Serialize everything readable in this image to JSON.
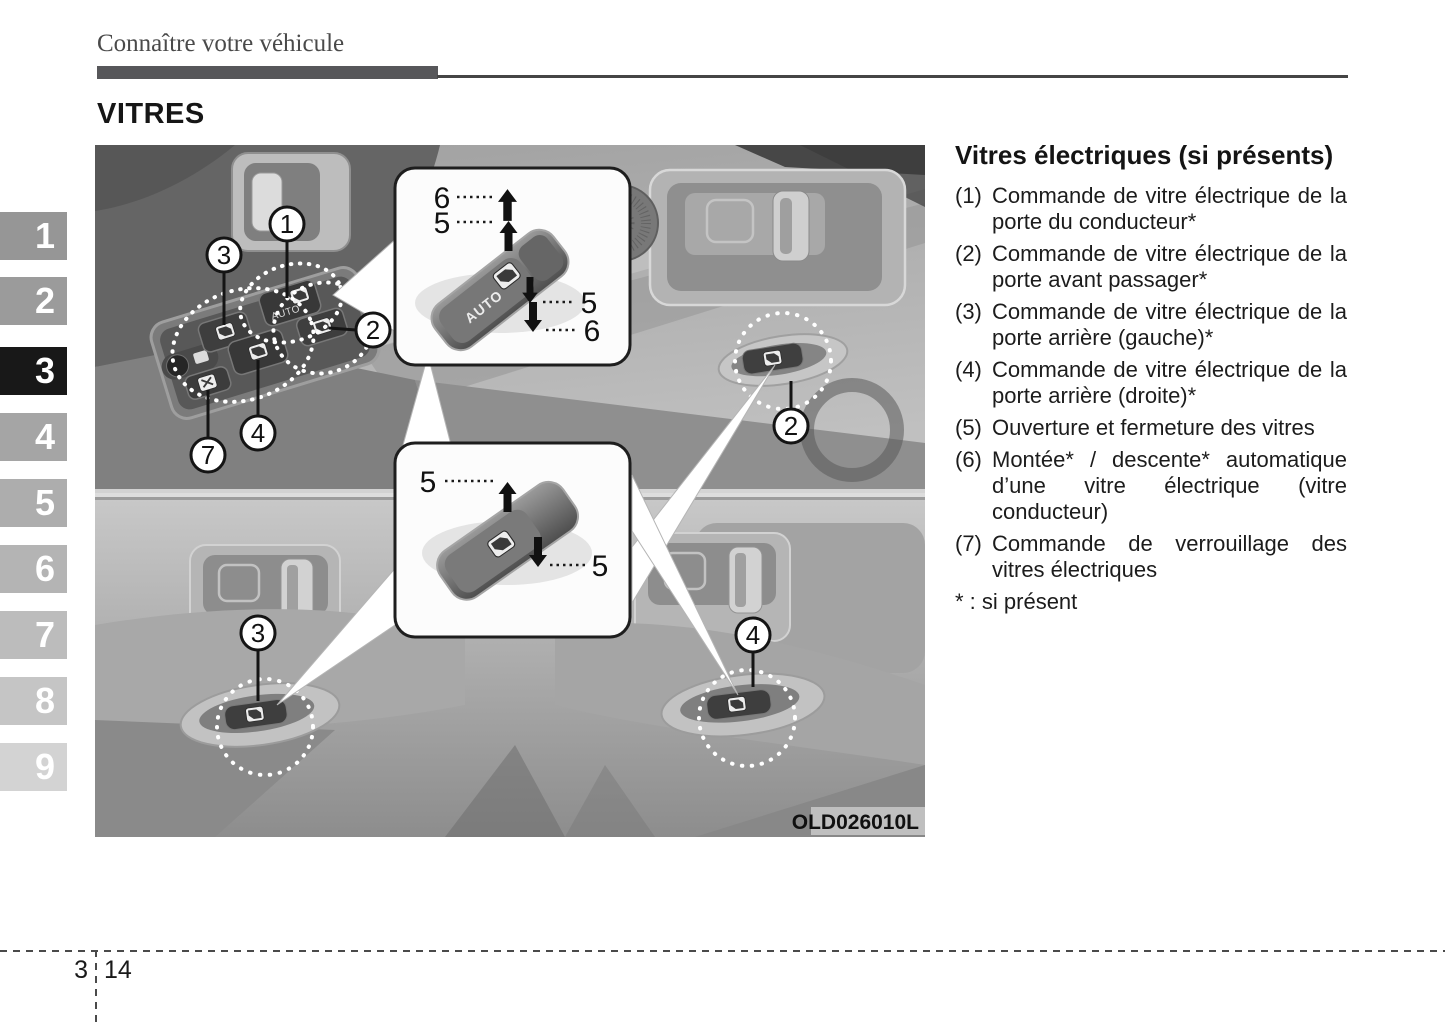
{
  "page": {
    "breadcrumb": "Connaître votre véhicule",
    "title": "VITRES",
    "footer": {
      "chapter": "3",
      "page": "14"
    }
  },
  "sidebar": {
    "tabs": [
      {
        "label": "1",
        "active": false
      },
      {
        "label": "2",
        "active": false
      },
      {
        "label": "3",
        "active": true
      },
      {
        "label": "4",
        "active": false
      },
      {
        "label": "5",
        "active": false
      },
      {
        "label": "6",
        "active": false
      },
      {
        "label": "7",
        "active": false
      },
      {
        "label": "8",
        "active": false
      },
      {
        "label": "9",
        "active": false
      }
    ]
  },
  "figure": {
    "code": "OLD026010L",
    "switch_auto_text": "AUTO",
    "callouts": {
      "driver_auto": "1",
      "cluster_front_passenger": "2",
      "cluster_rear_left": "3",
      "cluster_rear_right": "4",
      "window_lock": "7",
      "front_passenger_door": "2",
      "rear_left_door": "3",
      "rear_right_door": "4"
    },
    "inset_auto": {
      "up_auto": "6",
      "up_manual": "5",
      "down_manual": "5",
      "down_auto": "6"
    },
    "inset_manual": {
      "up": "5",
      "down": "5"
    }
  },
  "content": {
    "heading": "Vitres électriques (si présents)",
    "items": [
      {
        "num": "(1)",
        "text": "Commande de vitre électrique de la porte du conducteur*"
      },
      {
        "num": "(2)",
        "text": "Commande de vitre électrique de la porte avant passager*"
      },
      {
        "num": "(3)",
        "text": "Commande de vitre électrique de la porte arrière (gauche)*"
      },
      {
        "num": "(4)",
        "text": "Commande de vitre électrique de la porte arrière (droite)*"
      },
      {
        "num": "(5)",
        "text": "Ouverture et fermeture des vitres"
      },
      {
        "num": "(6)",
        "text": "Montée* / descente* automatique d’une vitre électrique (vitre conducteur)"
      },
      {
        "num": "(7)",
        "text": "Commande de verrouillage des vitres électriques"
      }
    ],
    "footnote": "* : si présent"
  },
  "colors": {
    "active_tab": "#181818",
    "tab_text": "#ffffff",
    "rule": "#57575a",
    "accent": "#1a1a1a"
  }
}
